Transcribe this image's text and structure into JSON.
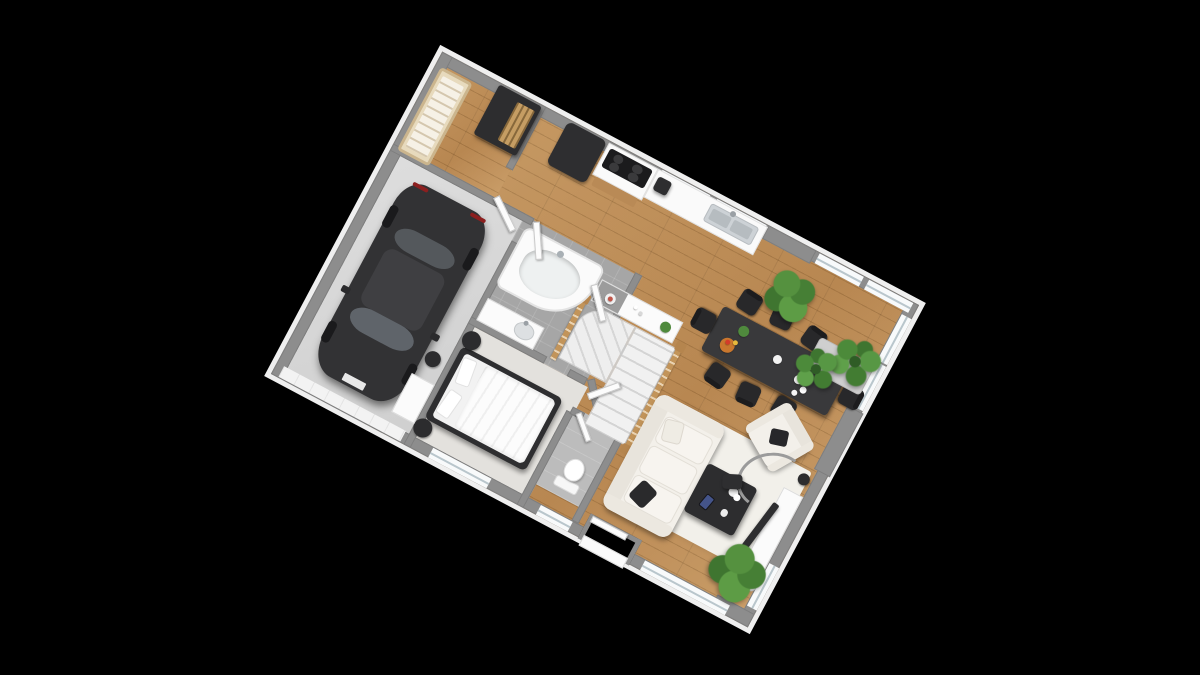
{
  "app": {
    "title": "3D floor plan render",
    "background": "#000000"
  },
  "view": {
    "rotation_deg": 28,
    "plan_left": 320,
    "plan_top": 152,
    "plan_width": 540,
    "plan_height": 365
  },
  "palette": {
    "wood": "#bd8d55",
    "concrete": "#d6d6d6",
    "tile": "#a6a6a6",
    "carpet": "#e3e1dd",
    "wall_cap": "#8d8d8d",
    "exterior_face": "#efefef",
    "furniture_dark": "#2e2e30",
    "sofa_white": "#f3f0ea",
    "rail_wood": "#c2945a",
    "plant_green": "#55913f",
    "glass": "#b9c6cc",
    "steel": "#cdd2d6",
    "car_body": "#323234"
  },
  "scene": {
    "items": [
      {
        "n": "floor-main-living",
        "t": "floorWood",
        "x": 104,
        "y": 0,
        "w": 436,
        "h": 365
      },
      {
        "n": "floor-nursery",
        "t": "floorWood",
        "x": 0,
        "y": 0,
        "w": 116,
        "h": 112
      },
      {
        "n": "floor-garage",
        "t": "floorConcrete",
        "x": 0,
        "y": 106,
        "w": 156,
        "h": 259
      },
      {
        "n": "floor-bathroom",
        "t": "floorTile",
        "x": 150,
        "y": 106,
        "w": 132,
        "h": 122
      },
      {
        "n": "floor-bedroom",
        "t": "floorCarpet",
        "x": 150,
        "y": 228,
        "w": 136,
        "h": 137
      },
      {
        "n": "floor-wc",
        "t": "floorTile2",
        "x": 282,
        "y": 252,
        "w": 58,
        "h": 86
      },
      {
        "n": "living-rug",
        "t": "rug",
        "x": 378,
        "y": 198,
        "w": 146,
        "h": 118
      },
      {
        "n": "wall-exterior-top",
        "t": "wall",
        "x": 0,
        "y": 0,
        "w": 540,
        "h": 12
      },
      {
        "n": "wall-exterior-bottom",
        "t": "wall",
        "x": 0,
        "y": 353,
        "w": 540,
        "h": 12
      },
      {
        "n": "wall-exterior-left",
        "t": "wall",
        "x": 0,
        "y": 0,
        "w": 12,
        "h": 365
      },
      {
        "n": "wall-exterior-right",
        "t": "wall",
        "x": 528,
        "y": 0,
        "w": 12,
        "h": 365
      },
      {
        "n": "wall-pier-top",
        "t": "pier",
        "x": 370,
        "y": 0,
        "w": 54,
        "h": 15
      },
      {
        "n": "wall-pier-right",
        "t": "pier",
        "x": 524,
        "y": 122,
        "w": 18,
        "h": 72
      },
      {
        "n": "wall-pier-bottom-right",
        "t": "pier",
        "x": 498,
        "y": 350,
        "w": 42,
        "h": 15
      },
      {
        "n": "window-kitchen-1",
        "t": "winH",
        "x": 250,
        "y": 1,
        "w": 54,
        "h": 11
      },
      {
        "n": "window-kitchen-2",
        "t": "winH",
        "x": 312,
        "y": 1,
        "w": 56,
        "h": 11
      },
      {
        "n": "window-top-right-1",
        "t": "winH",
        "x": 428,
        "y": 1,
        "w": 50,
        "h": 11
      },
      {
        "n": "window-top-right-2",
        "t": "winH",
        "x": 484,
        "y": 1,
        "w": 50,
        "h": 11
      },
      {
        "n": "window-right-1",
        "t": "winV",
        "x": 529,
        "y": 16,
        "w": 11,
        "h": 52
      },
      {
        "n": "window-right-2",
        "t": "winV",
        "x": 529,
        "y": 70,
        "w": 11,
        "h": 50
      },
      {
        "n": "window-right-tv",
        "t": "winV",
        "x": 529,
        "y": 298,
        "w": 11,
        "h": 48
      },
      {
        "n": "window-bedroom",
        "t": "winH",
        "x": 178,
        "y": 354,
        "w": 66,
        "h": 11
      },
      {
        "n": "window-wc",
        "t": "winH",
        "x": 300,
        "y": 354,
        "w": 36,
        "h": 11
      },
      {
        "n": "window-living-bottom",
        "t": "winH",
        "x": 418,
        "y": 354,
        "w": 96,
        "h": 11
      },
      {
        "n": "garage-door",
        "t": "garageDoor",
        "x": 8,
        "y": 352,
        "w": 138,
        "h": 12
      },
      {
        "n": "entry-notch",
        "t": "notch",
        "x": 348,
        "y": 338,
        "w": 58,
        "h": 28
      },
      {
        "n": "entry-porch-step",
        "t": "whiteBox",
        "x": 352,
        "y": 360,
        "w": 50,
        "h": 12
      },
      {
        "n": "front-door",
        "t": "door",
        "x": 351,
        "y": 339,
        "w": 40,
        "h": 7
      },
      {
        "n": "wall-nursery-right",
        "t": "wall",
        "x": 110,
        "y": 0,
        "w": 8,
        "h": 72
      },
      {
        "n": "wall-nursery-garage-top",
        "t": "wall",
        "x": 0,
        "y": 104,
        "w": 160,
        "h": 8
      },
      {
        "n": "wall-garage-right",
        "t": "wall",
        "x": 150,
        "y": 134,
        "w": 8,
        "h": 231
      },
      {
        "n": "wall-bath-right",
        "t": "wall",
        "x": 274,
        "y": 104,
        "w": 8,
        "h": 58
      },
      {
        "n": "wall-bath-diagonal",
        "t": "wall",
        "x": 274,
        "y": 158,
        "w": 8,
        "h": 58,
        "r": -44,
        "o": "left top"
      },
      {
        "n": "wall-bath-bottom-1",
        "t": "wall",
        "x": 150,
        "y": 220,
        "w": 86,
        "h": 8
      },
      {
        "n": "wall-bath-bottom-2",
        "t": "wall",
        "x": 262,
        "y": 220,
        "w": 20,
        "h": 8
      },
      {
        "n": "wall-bedroom-right",
        "t": "wall",
        "x": 278,
        "y": 258,
        "w": 8,
        "h": 107
      },
      {
        "n": "wall-bedroom-diagonal",
        "t": "wall",
        "x": 282,
        "y": 222,
        "w": 8,
        "h": 44,
        "r": -40,
        "o": "left top"
      },
      {
        "n": "wall-wc-right",
        "t": "wall",
        "x": 334,
        "y": 252,
        "w": 8,
        "h": 101
      },
      {
        "n": "wall-wc-top-1",
        "t": "wall",
        "x": 282,
        "y": 252,
        "w": 14,
        "h": 8
      },
      {
        "n": "wall-wc-top-2",
        "t": "wall",
        "x": 318,
        "y": 252,
        "w": 24,
        "h": 8
      },
      {
        "n": "stairs-console",
        "t": "console",
        "x": 248,
        "y": 126,
        "w": 92,
        "h": 24,
        "d": [
          {
            "x": 10,
            "y": 7,
            "s": 11,
            "c": "#f1f1f1"
          },
          {
            "x": 13,
            "y": 10,
            "s": 5,
            "c": "#c0564a"
          },
          {
            "x": 40,
            "y": 6,
            "s": 4,
            "c": "#ffffff"
          },
          {
            "x": 47,
            "y": 9,
            "s": 4,
            "c": "#d8d8d8"
          },
          {
            "x": 72,
            "y": 6,
            "s": 11,
            "c": "#4f8a3d"
          }
        ]
      },
      {
        "n": "stairs-winder",
        "t": "stairsW",
        "x": 246,
        "y": 152,
        "w": 54,
        "h": 64
      },
      {
        "n": "stairs-flight",
        "t": "stairsS",
        "x": 300,
        "y": 152,
        "w": 46,
        "h": 110
      },
      {
        "n": "stairs-railing-left",
        "t": "rail",
        "x": 239,
        "y": 152,
        "w": 6,
        "h": 68
      },
      {
        "n": "stairs-railing-right",
        "t": "rail",
        "x": 346,
        "y": 150,
        "w": 6,
        "h": 114
      },
      {
        "n": "stairs-newel-1",
        "t": "newel",
        "x": 237,
        "y": 146,
        "w": 10,
        "h": 10
      },
      {
        "n": "stairs-newel-2",
        "t": "newel",
        "x": 344,
        "y": 144,
        "w": 10,
        "h": 10
      },
      {
        "n": "stairs-newel-3",
        "t": "newel",
        "x": 344,
        "y": 260,
        "w": 10,
        "h": 10
      },
      {
        "n": "kitchen-fridge",
        "t": "darkBox",
        "x": 144,
        "y": 2,
        "w": 44,
        "h": 48,
        "rad": "6px"
      },
      {
        "n": "kitchen-cooktop-cabinet",
        "t": "cooktopCab",
        "x": 190,
        "y": 2,
        "w": 56,
        "h": 36
      },
      {
        "n": "kitchen-wood-shelf",
        "t": "shelf",
        "x": 194,
        "y": 38,
        "w": 48,
        "h": 10
      },
      {
        "n": "kitchen-counter-sink",
        "t": "counter",
        "x": 246,
        "y": 2,
        "w": 124,
        "h": 32
      },
      {
        "n": "kitchen-coffee-machine",
        "t": "darkBox",
        "x": 250,
        "y": 8,
        "w": 15,
        "h": 15,
        "rad": "3px"
      },
      {
        "n": "dining-table",
        "t": "table",
        "x": 368,
        "y": 92,
        "w": 142,
        "h": 50,
        "d": [
          {
            "x": 24,
            "y": 8,
            "s": 11,
            "c": "#4f8a3d"
          },
          {
            "x": 14,
            "y": 26,
            "s": 15,
            "c": "#c9772e"
          },
          {
            "x": 18,
            "y": 28,
            "s": 5,
            "c": "#d43c2a"
          },
          {
            "x": 25,
            "y": 25,
            "s": 5,
            "c": "#e7b93c"
          },
          {
            "x": 68,
            "y": 18,
            "s": 9,
            "c": "#f2f2f2"
          },
          {
            "x": 96,
            "y": 26,
            "s": 9,
            "c": "#ededed"
          },
          {
            "x": 106,
            "y": 34,
            "s": 7,
            "c": "#ffffff"
          },
          {
            "x": 100,
            "y": 41,
            "s": 6,
            "c": "#f6f6f6"
          }
        ]
      },
      {
        "n": "dining-chair-1",
        "t": "chair",
        "x": 378,
        "y": 66,
        "w": 22,
        "h": 22,
        "r": 5
      },
      {
        "n": "dining-chair-2",
        "t": "chair",
        "x": 414,
        "y": 64,
        "w": 22,
        "h": 22,
        "r": -4
      },
      {
        "n": "dining-chair-3",
        "t": "chair",
        "x": 452,
        "y": 68,
        "w": 22,
        "h": 22,
        "r": 8
      },
      {
        "n": "dining-chair-4",
        "t": "chair",
        "x": 384,
        "y": 146,
        "w": 22,
        "h": 22,
        "r": 187
      },
      {
        "n": "dining-chair-5",
        "t": "chair",
        "x": 420,
        "y": 148,
        "w": 22,
        "h": 22,
        "r": 176
      },
      {
        "n": "dining-chair-6",
        "t": "chair",
        "x": 458,
        "y": 144,
        "w": 22,
        "h": 22,
        "r": 184
      },
      {
        "n": "dining-chair-7",
        "t": "chair",
        "x": 346,
        "y": 104,
        "w": 22,
        "h": 22,
        "r": -90
      },
      {
        "n": "dining-chair-8",
        "t": "chair",
        "x": 512,
        "y": 102,
        "w": 22,
        "h": 22,
        "r": 90
      },
      {
        "n": "plant-dining-wall",
        "t": "plant",
        "x": 396,
        "y": 28,
        "w": 50,
        "h": 50,
        "r": 15
      },
      {
        "n": "plant-planter-corner",
        "t": "planter",
        "x": 468,
        "y": 74,
        "w": 62,
        "h": 34
      },
      {
        "n": "plant-palm-1",
        "t": "palm",
        "x": 486,
        "y": 56,
        "w": 48,
        "h": 48,
        "r": 10
      },
      {
        "n": "plant-palm-2",
        "t": "palm",
        "x": 458,
        "y": 84,
        "w": 42,
        "h": 42,
        "r": -20
      },
      {
        "n": "living-sofa",
        "t": "sofa",
        "x": 352,
        "y": 198,
        "w": 76,
        "h": 128
      },
      {
        "n": "living-armchair",
        "t": "armchair",
        "x": 452,
        "y": 156,
        "w": 54,
        "h": 52,
        "r": 32
      },
      {
        "n": "living-coffee-table",
        "t": "coffeeTable",
        "x": 428,
        "y": 238,
        "w": 56,
        "h": 54
      },
      {
        "n": "living-floor-lamp-arc",
        "t": "arc",
        "x": 458,
        "y": 196,
        "w": 70,
        "h": 58,
        "r": -32
      },
      {
        "n": "living-floor-lamp-shade",
        "t": "darkBox",
        "x": 448,
        "y": 236,
        "w": 20,
        "h": 15,
        "r": -25,
        "rad": "4px"
      },
      {
        "n": "living-floor-lamp-base",
        "t": "circleDark",
        "x": 514,
        "y": 202,
        "w": 12,
        "h": 12
      },
      {
        "n": "living-tv-console",
        "t": "whiteBox",
        "x": 506,
        "y": 224,
        "w": 22,
        "h": 90
      },
      {
        "n": "living-tv",
        "t": "darkBox",
        "x": 500,
        "y": 242,
        "w": 7,
        "h": 54,
        "r": 9,
        "rad": "2px"
      },
      {
        "n": "living-pot-1",
        "t": "circleWhite",
        "x": 508,
        "y": 316,
        "w": 11,
        "h": 11
      },
      {
        "n": "living-pot-2",
        "t": "circleWhite",
        "x": 519,
        "y": 322,
        "w": 10,
        "h": 10
      },
      {
        "n": "plant-living",
        "t": "plant",
        "x": 476,
        "y": 294,
        "w": 56,
        "h": 56,
        "r": 40
      },
      {
        "n": "bedroom-bed",
        "t": "bed",
        "x": 156,
        "y": 250,
        "w": 114,
        "h": 82
      },
      {
        "n": "bedroom-nightstand-1",
        "t": "circleDark",
        "x": 152,
        "y": 232,
        "w": 19,
        "h": 19
      },
      {
        "n": "bedroom-nightstand-2",
        "t": "circleDark",
        "x": 150,
        "y": 332,
        "w": 19,
        "h": 19
      },
      {
        "n": "bathroom-corner-tub",
        "t": "tub",
        "x": 156,
        "y": 114,
        "w": 90,
        "h": 68
      },
      {
        "n": "bathroom-vanity",
        "t": "vanity",
        "x": 156,
        "y": 196,
        "w": 64,
        "h": 25
      },
      {
        "n": "wc-toilet",
        "t": "toilet",
        "x": 298,
        "y": 296,
        "w": 30,
        "h": 34
      },
      {
        "n": "garage-car",
        "t": "car",
        "x": 28,
        "y": 126,
        "w": 98,
        "h": 214
      },
      {
        "n": "garage-cabinet",
        "t": "whiteBox",
        "x": 124,
        "y": 298,
        "w": 26,
        "h": 44
      },
      {
        "n": "garage-bin",
        "t": "circleDark",
        "x": 128,
        "y": 268,
        "w": 16,
        "h": 16
      },
      {
        "n": "nursery-crib",
        "t": "crib",
        "x": 6,
        "y": 14,
        "w": 36,
        "h": 94
      },
      {
        "n": "nursery-wardrobe",
        "t": "wardrobe",
        "x": 66,
        "y": 2,
        "w": 48,
        "h": 56
      },
      {
        "n": "door-nursery",
        "t": "door",
        "x": 118,
        "y": 100,
        "w": 38,
        "h": 7,
        "r": 36,
        "o": "left top"
      },
      {
        "n": "door-garage",
        "t": "door",
        "x": 160,
        "y": 108,
        "w": 7,
        "h": 38,
        "r": -32,
        "o": "left top"
      },
      {
        "n": "door-bathroom",
        "t": "door",
        "x": 246,
        "y": 132,
        "w": 38,
        "h": 7,
        "r": 48,
        "o": "left top"
      },
      {
        "n": "door-bedroom",
        "t": "door",
        "x": 288,
        "y": 234,
        "w": 34,
        "h": 7,
        "r": -48,
        "o": "left top"
      },
      {
        "n": "door-wc",
        "t": "door",
        "x": 292,
        "y": 253,
        "w": 30,
        "h": 6,
        "r": 42,
        "o": "left top"
      }
    ]
  }
}
